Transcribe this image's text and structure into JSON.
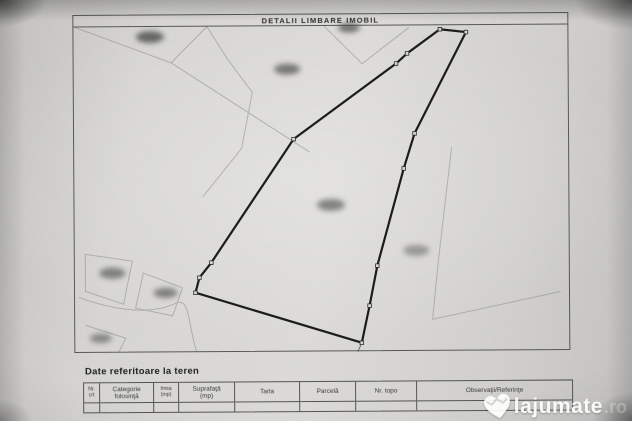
{
  "colors": {
    "boundary": "#1c1c1c",
    "frame_line": "#5a5a5a",
    "faint_parcel_line": "#8f8f8f",
    "paper": "#dadad7",
    "watermark_text": "#ffffff",
    "redaction_smudge": "#383838"
  },
  "plan": {
    "title": "DETALII LIMBARE IMOBIL",
    "map": {
      "polygon_points": "441,30 467,33 415,134 404,169 377,266 369,306 361,343 195,292 199,277 211,262 294,139 397,64 408,54",
      "markers": [
        [
          441,
          30
        ],
        [
          467,
          33
        ],
        [
          415,
          134
        ],
        [
          404,
          169
        ],
        [
          377,
          266
        ],
        [
          369,
          306
        ],
        [
          361,
          343
        ],
        [
          195,
          292
        ],
        [
          199,
          277
        ],
        [
          211,
          262
        ],
        [
          294,
          139
        ],
        [
          397,
          64
        ],
        [
          408,
          54
        ]
      ],
      "redacted_labels": [
        [
          151,
          36,
          14,
          0.7
        ],
        [
          350,
          28,
          11,
          0.65
        ],
        [
          288,
          69,
          13,
          0.6
        ],
        [
          331,
          205,
          14,
          0.55
        ],
        [
          416,
          251,
          13,
          0.4
        ],
        [
          112,
          272,
          13,
          0.55
        ],
        [
          165,
          292,
          12,
          0.55
        ],
        [
          100,
          337,
          11,
          0.5
        ]
      ]
    }
  },
  "terrain_section": {
    "heading": "Date referitoare la teren",
    "table": {
      "columns": [
        {
          "label_lines": [
            "Nr.",
            "crt"
          ]
        },
        {
          "label_lines": [
            "Categorie",
            "folosinţă"
          ]
        },
        {
          "label_lines": [
            "Imsa",
            "(mp)"
          ]
        },
        {
          "label_lines": [
            "Suprafaţă",
            "(mp)"
          ]
        },
        {
          "label_lines": [
            "Tarla"
          ]
        },
        {
          "label_lines": [
            "Parcelă"
          ]
        },
        {
          "label_lines": [
            "Nr. topo"
          ]
        },
        {
          "label_lines": [
            "Observaţii/Referinţe"
          ]
        }
      ],
      "rows": [
        [
          "",
          "",
          "",
          "",
          "",
          "",
          "",
          ""
        ]
      ]
    }
  },
  "watermark": {
    "brand": "lajumate",
    "tld": ".ro"
  }
}
